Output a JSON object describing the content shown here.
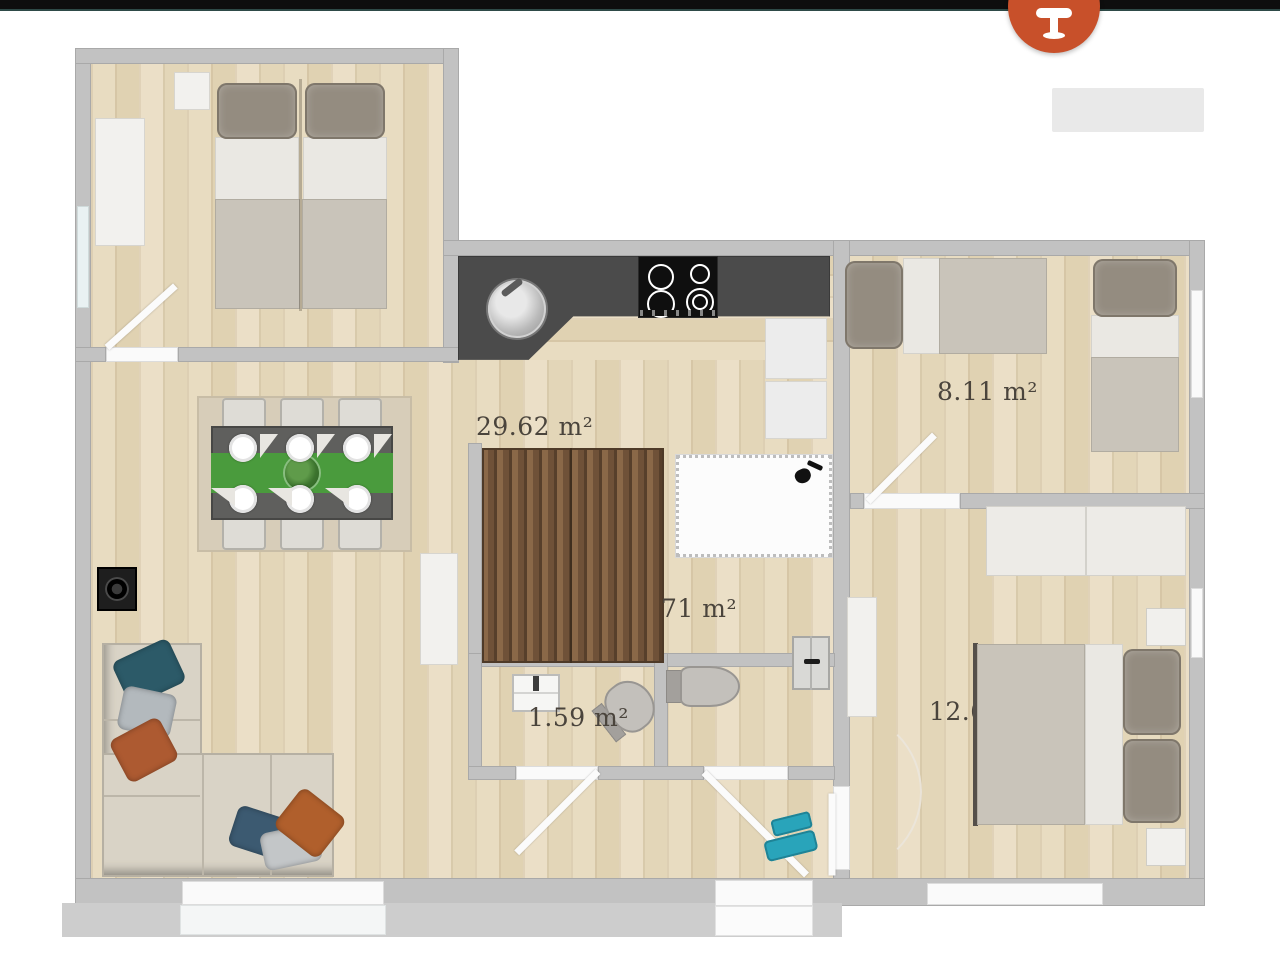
{
  "chrome": {
    "top_bar_color": "#0e0e0e",
    "fab": {
      "icon": "pedestal-table-icon",
      "color": "#c8502a"
    },
    "placeholder_button": {
      "label": ""
    }
  },
  "plan": {
    "labels": [
      {
        "id": "room-main",
        "text": "29.62 m²"
      },
      {
        "id": "room-top-right",
        "text": "8.11 m²"
      },
      {
        "id": "room-partial",
        "text": "71 m²"
      },
      {
        "id": "room-wc",
        "text": "1.59 m²"
      },
      {
        "id": "room-bottom-right",
        "text": "12.6"
      }
    ],
    "colors": {
      "wall": "#c2c2c2",
      "floor": "#e3d6ba",
      "counter": "#4b4b4b",
      "stairs": "#82613f",
      "sofa": "#d9d3c6",
      "runner_green": "#4a9b3d",
      "shoes_teal": "#29a4ba",
      "label_text": "#4a443c"
    }
  }
}
